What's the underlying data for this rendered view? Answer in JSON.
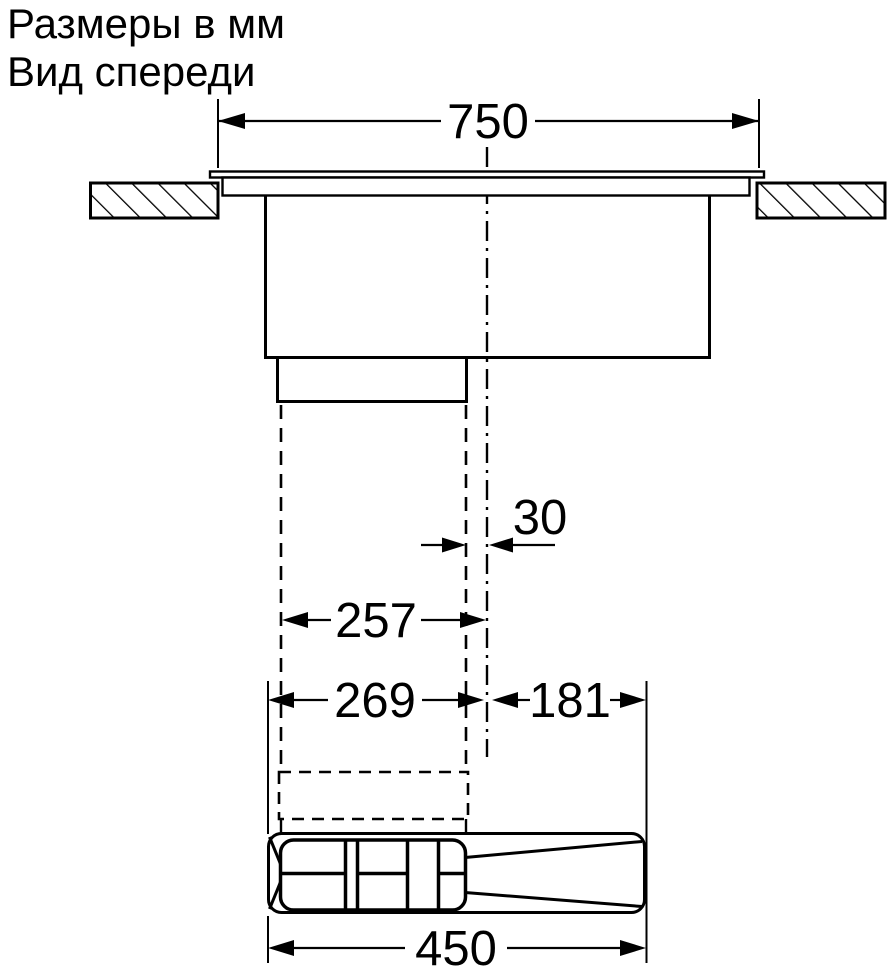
{
  "header": {
    "title_line1": "Размеры в мм",
    "title_line2": "Вид спереди"
  },
  "drawing": {
    "type": "installation-dimension-diagram",
    "view": "front",
    "ink_color": "#000000",
    "background_color": "#ffffff",
    "dims": {
      "top_width": "750",
      "center_offset": "30",
      "duct_width": "257",
      "left_span": "269",
      "right_span": "181",
      "plinth_unit_width": "450"
    }
  }
}
